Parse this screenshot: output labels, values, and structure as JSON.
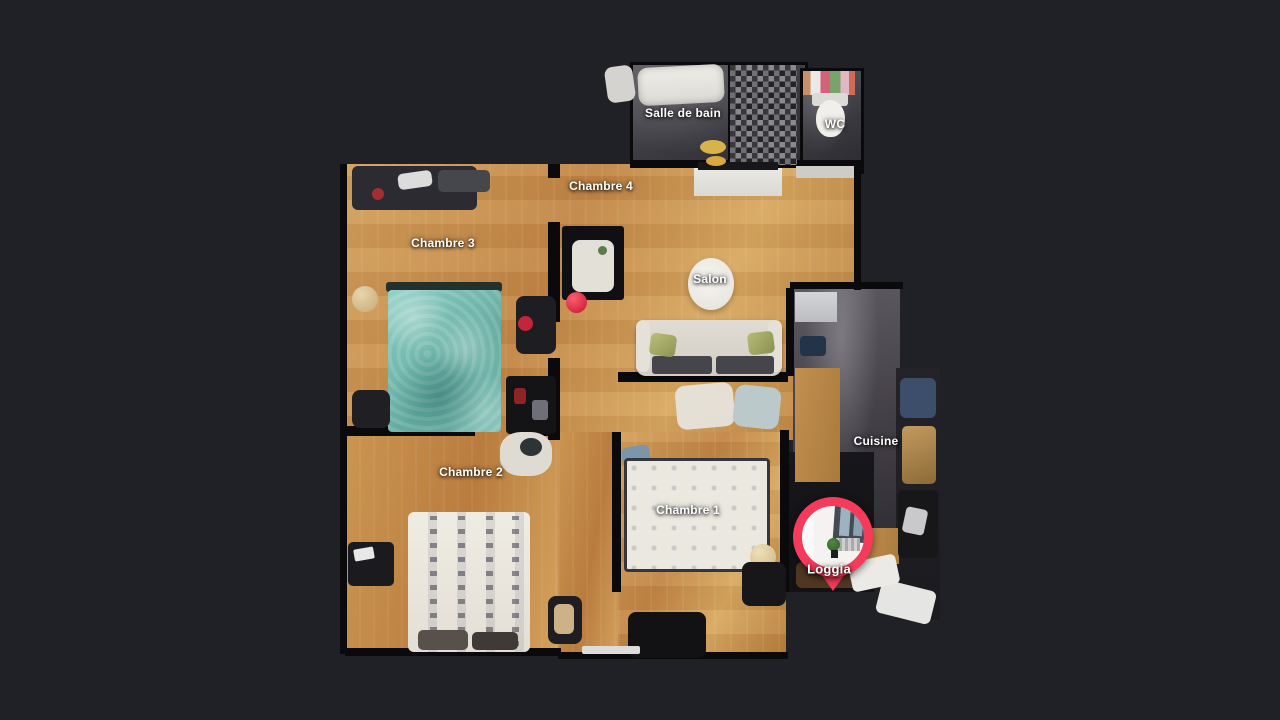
{
  "app": {
    "name": "3D tour floor plan viewer",
    "background_color": "#1f2126",
    "view": "dollhouse-floorplan-top-down"
  },
  "rooms": [
    {
      "id": "salle-de-bain",
      "label": "Salle de bain"
    },
    {
      "id": "wc",
      "label": "WC"
    },
    {
      "id": "chambre-4",
      "label": "Chambre 4"
    },
    {
      "id": "chambre-3",
      "label": "Chambre 3"
    },
    {
      "id": "salon",
      "label": "Salon"
    },
    {
      "id": "cuisine",
      "label": "Cuisine"
    },
    {
      "id": "chambre-2",
      "label": "Chambre 2"
    },
    {
      "id": "chambre-1",
      "label": "Chambre 1"
    },
    {
      "id": "loggia",
      "label": "Loggia"
    }
  ],
  "marker": {
    "room": "Loggia",
    "type": "location-pin",
    "color": "#f53b5b"
  }
}
